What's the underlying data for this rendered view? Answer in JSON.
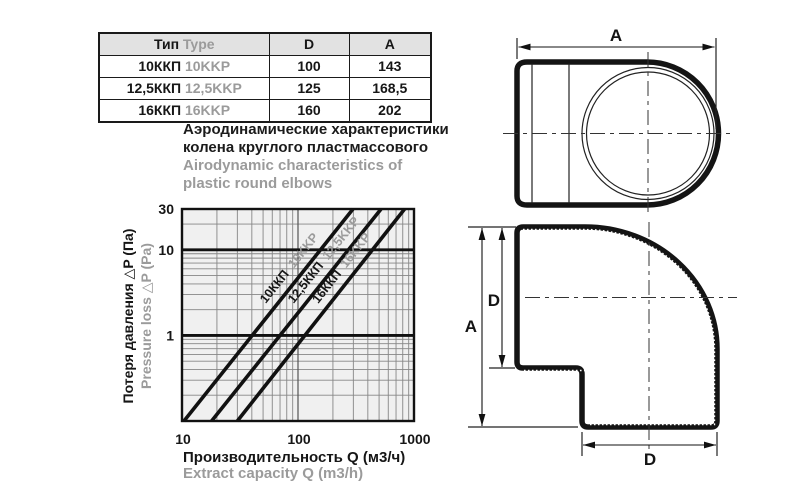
{
  "colors": {
    "ink": "#161616",
    "gray": "#9b9b9b",
    "plot_bg": "#f0f0f0",
    "grid_minor": "#868686",
    "grid_dark": "#555555",
    "line": "#111111",
    "table_header_bg": "#e2e2e2"
  },
  "table": {
    "header": {
      "type_ru": "Тип",
      "type_en": "Type",
      "col_d": "D",
      "col_a": "A"
    },
    "rows": [
      {
        "type_ru": "10ККП",
        "type_en": "10KKP",
        "d": "100",
        "a": "143"
      },
      {
        "type_ru": "12,5ККП",
        "type_en": "12,5KKP",
        "d": "125",
        "a": "168,5"
      },
      {
        "type_ru": "16ККП",
        "type_en": "16KKP",
        "d": "160",
        "a": "202"
      }
    ]
  },
  "heading": {
    "line1_ru": "Аэродинамические характеристики",
    "line2_ru": "колена круглого пластмассового",
    "line1_en": "Airodynamic characteristics of",
    "line2_en": "plastic round elbows"
  },
  "chart_data": {
    "type": "line",
    "scale": "log-log",
    "grid": true,
    "x_axis": {
      "label_ru": "Производительность Q (м3/ч)",
      "label_en": "Extract capacity Q (m3/h)",
      "scale": "log",
      "range": [
        10,
        1000
      ],
      "ticks": [
        {
          "value": 10,
          "label": "10"
        },
        {
          "value": 100,
          "label": "100"
        },
        {
          "value": 1000,
          "label": "1000"
        }
      ]
    },
    "y_axis": {
      "label_ru": "Потеря давления △P (Па)",
      "label_en": "Pressure loss △P (Pa)",
      "scale": "log",
      "range": [
        0.1,
        30
      ],
      "ticks": [
        {
          "value": 30,
          "label": "30"
        },
        {
          "value": 10,
          "label": "10"
        },
        {
          "value": 1,
          "label": "1"
        }
      ],
      "bold_gridlines": [
        1,
        10
      ]
    },
    "series": [
      {
        "label_ru": "10ККП",
        "label_en": "10KKP",
        "points": [
          [
            10.4,
            0.1
          ],
          [
            298,
            30
          ]
        ]
      },
      {
        "label_ru": "12,5ККП",
        "label_en": "12,5KKP",
        "points": [
          [
            18,
            0.1
          ],
          [
            520,
            30
          ]
        ]
      },
      {
        "label_ru": "16ККП",
        "label_en": "16KKP",
        "points": [
          [
            30,
            0.1
          ],
          [
            830,
            30
          ]
        ]
      }
    ]
  },
  "drawings": {
    "top_view": {
      "width_label": "A"
    },
    "side_view": {
      "height_label": "A",
      "inlet_label": "D",
      "outlet_label": "D"
    }
  }
}
